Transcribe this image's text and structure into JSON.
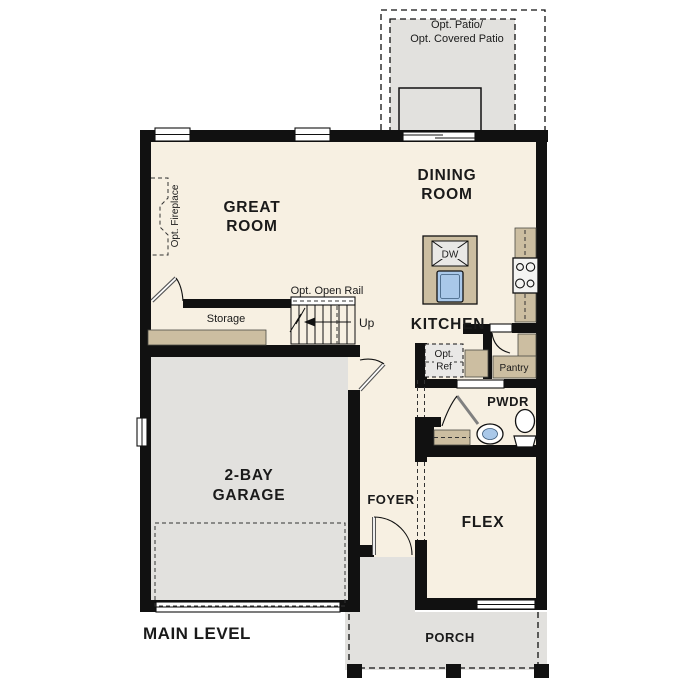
{
  "plan": {
    "title": "MAIN LEVEL"
  },
  "rooms": {
    "great_room": {
      "line1": "GREAT",
      "line2": "ROOM"
    },
    "dining_room": {
      "line1": "DINING",
      "line2": "ROOM"
    },
    "kitchen": {
      "label": "KITCHEN"
    },
    "storage": {
      "label": "Storage"
    },
    "garage": {
      "line1": "2-BAY",
      "line2": "GARAGE"
    },
    "foyer": {
      "label": "FOYER"
    },
    "flex": {
      "label": "FLEX"
    },
    "powder": {
      "label": "PWDR"
    },
    "pantry": {
      "label": "Pantry"
    },
    "porch": {
      "label": "PORCH"
    }
  },
  "annotations": {
    "patio": {
      "line1": "Opt. Patio/",
      "line2": "Opt. Covered Patio"
    },
    "fireplace": {
      "label": "Opt. Fireplace"
    },
    "open_rail": {
      "label": "Opt. Open Rail"
    },
    "stairs_direction": {
      "label": "Up"
    },
    "refrigerator": {
      "line1": "Opt.",
      "line2": "Ref"
    },
    "dishwasher": {
      "label": "DW"
    }
  },
  "colors": {
    "floor": "#f7f0e2",
    "hard_surface": "#e2e1de",
    "cabinet": "#ccbea1",
    "wall": "#111111",
    "sink_blue": "#a9c8e9",
    "fixture": "#e9e8e6",
    "text": "#1a1a1a"
  }
}
